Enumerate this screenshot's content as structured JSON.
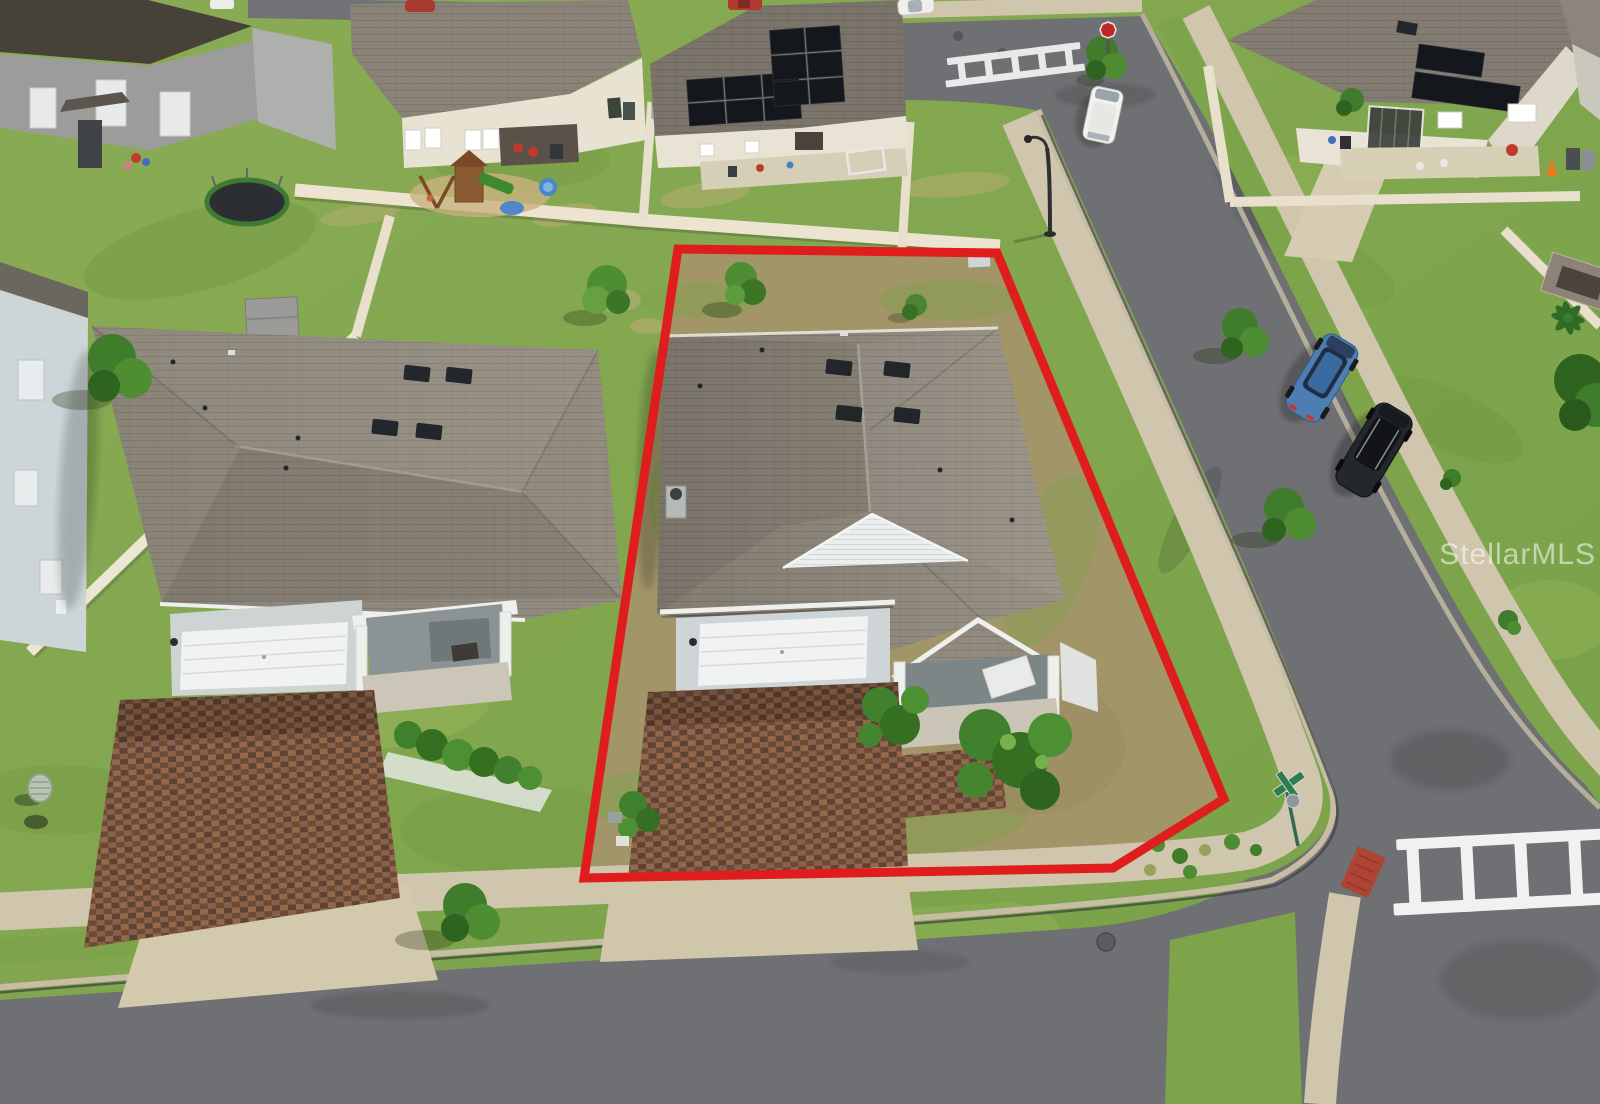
{
  "watermark": {
    "text": "StellarMLS",
    "color": "rgba(255,255,255,0.55)"
  },
  "property_outline": {
    "label": "subject property boundary",
    "color": "#e01d1d",
    "stroke_width": 9,
    "points": "678,249 997,253 1224,799 1113,868 584,878"
  },
  "palette": {
    "grass": "#84a751",
    "dry_lot_grass": "#a29669",
    "asphalt": "#6f7073",
    "sidewalk_concrete": "#cfc6ad",
    "paver_driveway": "#7a5742",
    "roof_shingle": "#8d867b",
    "vinyl_fence": "#ece4d1",
    "wall_cream": "#e7e2d4",
    "garage_door_white": "#f1f3f3",
    "solar_panel": "#14171c",
    "ada_pad_red": "#b04434",
    "stop_sign_red": "#c0272a",
    "street_sign_green": "#2e7d4f"
  },
  "scene": {
    "type": "aerial-drone-photo",
    "subject": "single-story home with gray shingle hip roof, white two-car garage door, covered front porch and brick paver driveway, outlined in red on a corner lot",
    "objects": [
      "red property boundary outline",
      "subject single-story house",
      "white two-car garage door",
      "covered entry porch with white columns",
      "brick paver driveway and walkway",
      "landscaped shrubs",
      "neighboring house with matching paver driveway",
      "cream vinyl privacy fences",
      "backyard playground, trampoline and kiddie pool",
      "rooftop solar panel arrays on neighboring homes",
      "curved asphalt streets with curbs and sidewalks",
      "ladder-style crosswalks",
      "red ADA curb ramp pad",
      "stop sign and green street-name sign",
      "street lamp",
      "parked vehicles along the curb",
      "parkway trees",
      "utility pedestal and ground boxes",
      "StellarMLS watermark"
    ],
    "vehicles": [
      {
        "name": "white-van",
        "color": "#f2f2ef"
      },
      {
        "name": "blue-suv",
        "color": "#4d7eb3"
      },
      {
        "name": "black-suv",
        "color": "#24272b"
      },
      {
        "name": "white-car",
        "color": "#efefec"
      },
      {
        "name": "red-car",
        "color": "#b23a31"
      }
    ]
  }
}
